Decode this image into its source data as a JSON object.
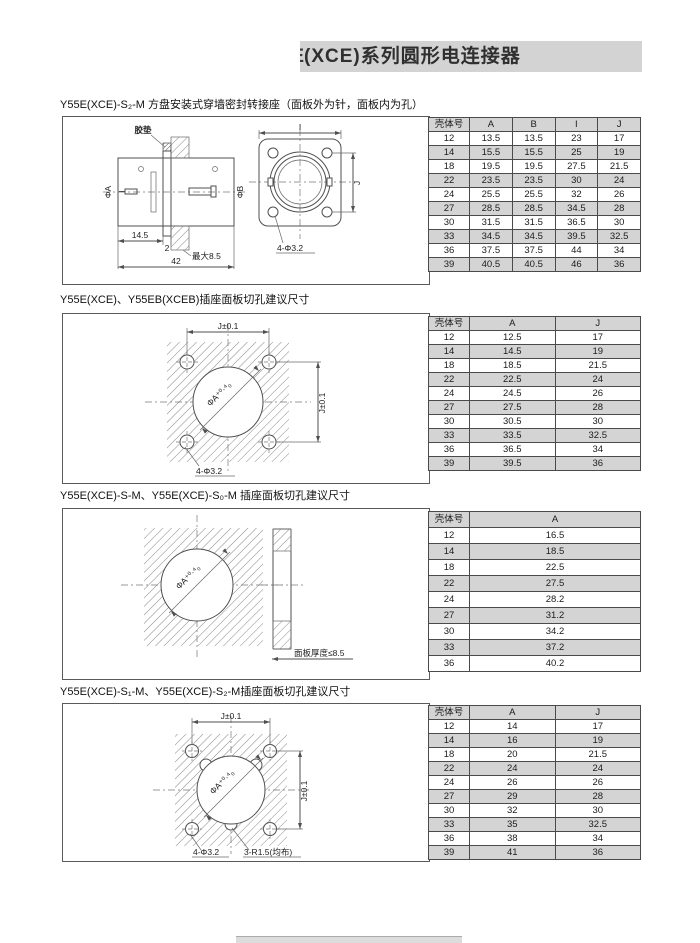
{
  "header": {
    "clipped_prefix": "E",
    "title": "(XCE)系列圆形电连接器"
  },
  "sections": [
    {
      "title": "Y55E(XCE)-S₂-M 方盘安装式穿墙密封转接座（面板外为针，面板内为孔）"
    },
    {
      "title": "Y55E(XCE)、Y55EB(XCEB)插座面板切孔建议尺寸"
    },
    {
      "title": "Y55E(XCE)-S-M、Y55E(XCE)-S₀-M 插座面板切孔建议尺寸"
    },
    {
      "title": "Y55E(XCE)-S₁-M、Y55E(XCE)-S₂-M插座面板切孔建议尺寸"
    }
  ],
  "tables": {
    "t1": {
      "headers": [
        "壳体号",
        "A",
        "B",
        "I",
        "J"
      ],
      "rows": [
        [
          "12",
          "13.5",
          "13.5",
          "23",
          "17"
        ],
        [
          "14",
          "15.5",
          "15.5",
          "25",
          "19"
        ],
        [
          "18",
          "19.5",
          "19.5",
          "27.5",
          "21.5"
        ],
        [
          "22",
          "23.5",
          "23.5",
          "30",
          "24"
        ],
        [
          "24",
          "25.5",
          "25.5",
          "32",
          "26"
        ],
        [
          "27",
          "28.5",
          "28.5",
          "34.5",
          "28"
        ],
        [
          "30",
          "31.5",
          "31.5",
          "36.5",
          "30"
        ],
        [
          "33",
          "34.5",
          "34.5",
          "39.5",
          "32.5"
        ],
        [
          "36",
          "37.5",
          "37.5",
          "44",
          "34"
        ],
        [
          "39",
          "40.5",
          "40.5",
          "46",
          "36"
        ]
      ]
    },
    "t2": {
      "headers": [
        "壳体号",
        "A",
        "J"
      ],
      "rows": [
        [
          "12",
          "12.5",
          "17"
        ],
        [
          "14",
          "14.5",
          "19"
        ],
        [
          "18",
          "18.5",
          "21.5"
        ],
        [
          "22",
          "22.5",
          "24"
        ],
        [
          "24",
          "24.5",
          "26"
        ],
        [
          "27",
          "27.5",
          "28"
        ],
        [
          "30",
          "30.5",
          "30"
        ],
        [
          "33",
          "33.5",
          "32.5"
        ],
        [
          "36",
          "36.5",
          "34"
        ],
        [
          "39",
          "39.5",
          "36"
        ]
      ]
    },
    "t3": {
      "headers": [
        "壳体号",
        "A"
      ],
      "rows": [
        [
          "12",
          "16.5"
        ],
        [
          "14",
          "18.5"
        ],
        [
          "18",
          "22.5"
        ],
        [
          "22",
          "27.5"
        ],
        [
          "24",
          "28.2"
        ],
        [
          "27",
          "31.2"
        ],
        [
          "30",
          "34.2"
        ],
        [
          "33",
          "37.2"
        ],
        [
          "36",
          "40.2"
        ]
      ]
    },
    "t4": {
      "headers": [
        "壳体号",
        "A",
        "J"
      ],
      "rows": [
        [
          "12",
          "14",
          "17"
        ],
        [
          "14",
          "16",
          "19"
        ],
        [
          "18",
          "20",
          "21.5"
        ],
        [
          "22",
          "24",
          "24"
        ],
        [
          "24",
          "26",
          "26"
        ],
        [
          "27",
          "29",
          "28"
        ],
        [
          "30",
          "32",
          "30"
        ],
        [
          "33",
          "35",
          "32.5"
        ],
        [
          "36",
          "38",
          "34"
        ],
        [
          "39",
          "41",
          "36"
        ]
      ]
    }
  },
  "drawings": {
    "d1": {
      "gasket": "胶垫",
      "phi_a": "ΦA",
      "phi_b": "ΦB",
      "dim_14_5": "14.5",
      "dim_2": "2",
      "dim_max": "最大8.5",
      "dim_42": "42",
      "dim_i": "I",
      "dim_j": "J",
      "holes": "4-Φ3.2"
    },
    "d2": {
      "dim_j_top": "J±0.1",
      "dim_j_right": "J±0.1",
      "phi_a": "ΦA⁺⁰·⁴₀",
      "holes": "4-Φ3.2"
    },
    "d3": {
      "phi_a": "ΦA⁺⁰·⁴₀",
      "thickness": "面板厚度≤8.5"
    },
    "d4": {
      "dim_j_top": "J±0.1",
      "dim_j_right": "J±0.1",
      "phi_a": "ΦA⁺⁰·⁴₀",
      "holes": "4-Φ3.2",
      "notches": "3-R1.5(均布)"
    }
  },
  "colors": {
    "banner_gray": "#d3d3d3",
    "table_shade": "#d4d4d4",
    "line": "#4f4f4f"
  }
}
